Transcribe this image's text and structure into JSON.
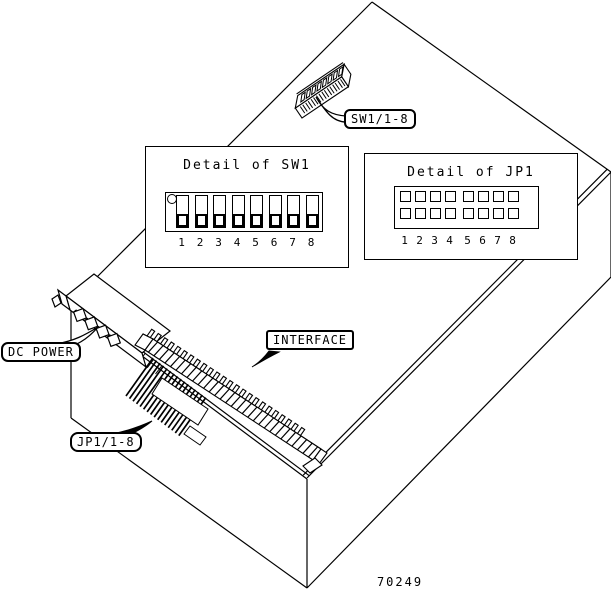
{
  "figure": {
    "number": "70249",
    "background_color": "#ffffff",
    "line_color": "#000000"
  },
  "details": {
    "sw1": {
      "title": "Detail of SW1",
      "positions": [
        "1",
        "2",
        "3",
        "4",
        "5",
        "6",
        "7",
        "8"
      ],
      "switch_count": 8,
      "lever_position_all": "down"
    },
    "jp1": {
      "title": "Detail of JP1",
      "positions": [
        "1",
        "2",
        "3",
        "4",
        "5",
        "6",
        "7",
        "8"
      ],
      "rows": 2,
      "columns": 8
    }
  },
  "callouts": {
    "sw1": {
      "label": "SW1/1-8"
    },
    "dc_power": {
      "label": "DC POWER"
    },
    "interface": {
      "label": "INTERFACE"
    },
    "jp1": {
      "label": "JP1/1-8"
    }
  },
  "components": {
    "sw1_dip_switch": {
      "position_count": 8
    },
    "dc_power_connector": {
      "pin_count": 4
    },
    "interface_connector": {
      "pin_count": 24
    },
    "jp1_jumper_block": {
      "pin_count": 8
    }
  }
}
